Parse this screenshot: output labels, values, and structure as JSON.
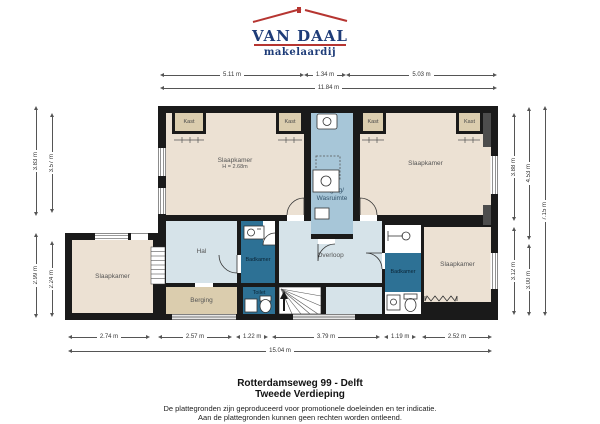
{
  "logo": {
    "title": "VAN DAAL",
    "subtitle": "makelaardij"
  },
  "title_block": {
    "address": "Rotterdamseweg 99 - Delft",
    "floor": "Tweede Verdieping",
    "disclaimer1": "De plattegronden zijn geproduceerd voor promotionele doeleinden en ter indicatie.",
    "disclaimer2": "Aan de plattegronden kunnen geen rechten worden ontleend."
  },
  "rooms": {
    "slaapkamer_tl": {
      "label": "Slaapkamer",
      "height_note": "H = 2.68m"
    },
    "slaapkamer_tr": {
      "label": "Slaapkamer"
    },
    "slaapkamer_br": {
      "label": "Slaapkamer"
    },
    "slaapkamer_annex": {
      "label": "Slaapkamer"
    },
    "hal": {
      "label": "Hal"
    },
    "overloop": {
      "label": "Overloop"
    },
    "berging_wasruimte": {
      "line1": "Berging/",
      "line2": "Wasruimte"
    },
    "berging": {
      "label": "Berging"
    },
    "badkamer_mid": {
      "label": "Badkamer"
    },
    "badkamer_right": {
      "label": "Badkamer"
    },
    "toilet": {
      "label": "Toilet"
    }
  },
  "closets": [
    "Kast",
    "Kast",
    "Kast",
    "Kast"
  ],
  "dimensions": {
    "top": [
      "5.11 m",
      "1.34 m",
      "5.03 m"
    ],
    "top_total": "11.84 m",
    "bottom": [
      "2.74 m",
      "2.57 m",
      "1.22 m",
      "3.79 m",
      "1.19 m",
      "2.52 m"
    ],
    "bottom_total": "15.04 m",
    "left_outer": [
      "3.83 m",
      "2.99 m"
    ],
    "left_inner": [
      "3.57 m",
      "2.24 m"
    ],
    "right_inner": [
      "3.88 m",
      "3.12 m"
    ],
    "right_mid": [
      "4.53 m",
      "3.00 m"
    ],
    "right_total": "7.15 m"
  },
  "colors": {
    "wall": "#1a1a1a",
    "room_beige": "#ece1d3",
    "closet_tan": "#dbcdae",
    "light_blue": "#d6e3e9",
    "mid_blue": "#a7c6d8",
    "dark_blue": "#2d7195",
    "brand_navy": "#1e3c78",
    "brand_red": "#b63531"
  },
  "icons": {
    "roof-icon": "red roofline with chimney",
    "washer-icon": "washing machine square with drum circle",
    "dryer-icon": "dashed appliance square",
    "sink-icon": "basin with tap circle",
    "toilet-icon": "toilet bowl oval with cistern",
    "shower-icon": "shower arm with head circle",
    "radiator-icon": "zigzag radiator",
    "stairs-up-icon": "staircase fan with up arrow",
    "door-arc-icon": "quarter-circle door swing",
    "window-icon": "double-line window"
  }
}
